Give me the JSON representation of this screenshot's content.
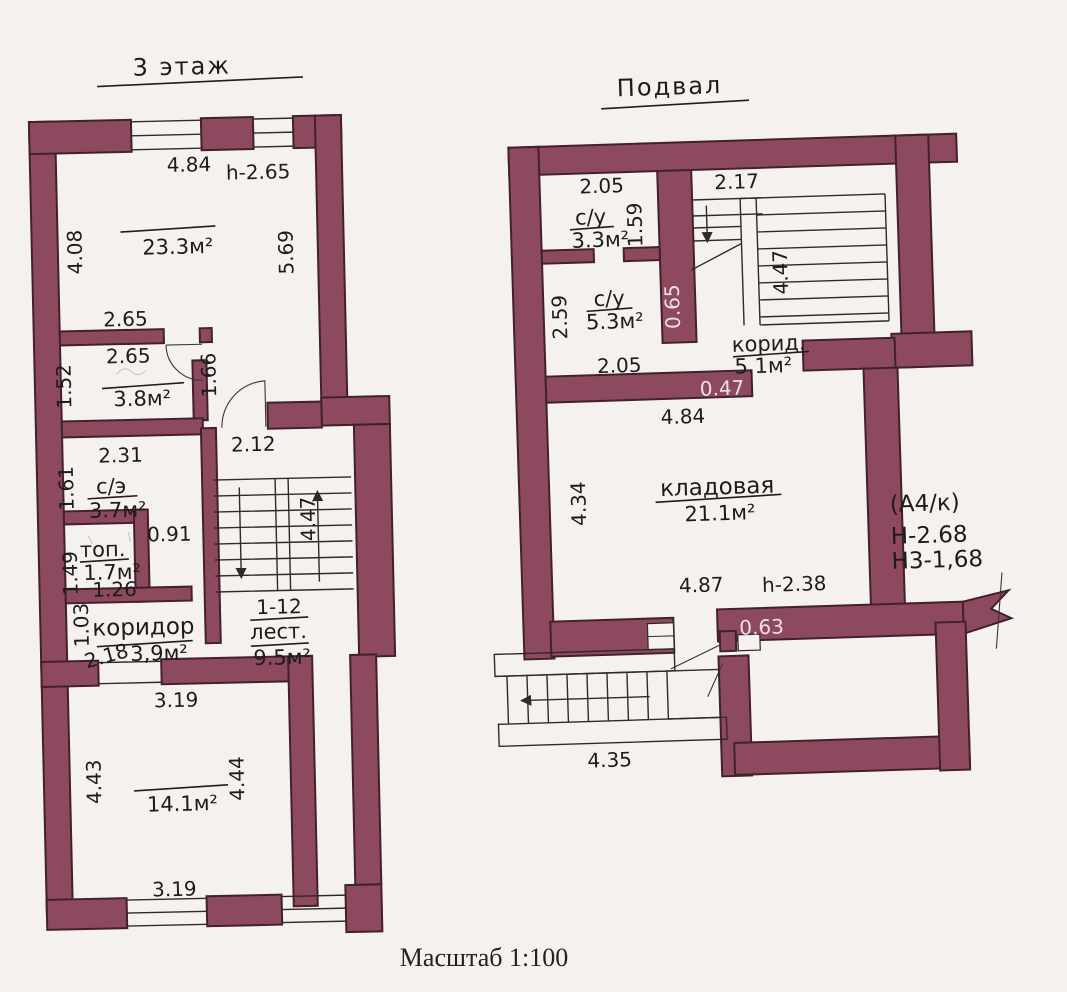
{
  "document": {
    "scale_label": "Масштаб 1:100"
  },
  "colors": {
    "wall_fill": "#8d4a5f",
    "wall_outline": "#42202d",
    "paper": "#f5f2ee",
    "ink": "#1d1b1b",
    "wall_label": "#eedfe4"
  },
  "floor3": {
    "title": "3 этаж",
    "room_233": {
      "area": "23.3м²",
      "dim_top": "4.84",
      "ceiling_height": "h-2.65",
      "dim_left": "4.08",
      "dim_right": "5.69"
    },
    "wall_dim": "2.65",
    "room_38": {
      "area": "3.8м²",
      "dim_top": "2.65",
      "dim_left": "1.52",
      "door_dim": "1.66"
    },
    "room_37": {
      "label": "с/э",
      "area": "3.7м²",
      "dim_top": "2.31",
      "dim_left": "1.61"
    },
    "room_17": {
      "label": "топ.",
      "area": "1.7м²",
      "dim_left": "1.49",
      "dim_right": "0.91",
      "dim_bottom": "1.26"
    },
    "corridor": {
      "label": "коридор",
      "area": "3,9м²",
      "dim_left": "1.03",
      "dim_width": "2.18"
    },
    "stairs": {
      "steps": "1-12",
      "label": "лест.",
      "area": "9.5м²",
      "dim_top": "2.12",
      "dim_right": "4.47"
    },
    "room_141": {
      "area": "14.1м²",
      "dim_top": "3.19",
      "dim_left": "4.43",
      "dim_right": "4.44",
      "dim_bottom": "3.19"
    }
  },
  "basement": {
    "title": "Подвал",
    "room_33": {
      "label": "с/у",
      "area": "3.3м²",
      "dim_top": "2.05",
      "dim_right": "1.59"
    },
    "room_53": {
      "label": "с/у",
      "area": "5.3м²",
      "dim_left": "2.59",
      "dim_bottom": "2.05"
    },
    "wall_065": "0.65",
    "stairs": {
      "dim_top": "2.17",
      "dim_right": "4.47"
    },
    "corridor": {
      "label": "корид.",
      "area": "5.1м²"
    },
    "wall_047": "0.47",
    "storage": {
      "label": "кладовая",
      "area": "21.1м²",
      "dim_top": "4.84",
      "dim_left": "4.34",
      "dim_bottom": "4.87",
      "ceiling_height": "h-2.38"
    },
    "annotation": {
      "line1": "(А4/к)",
      "line2": "Н-2.68",
      "line3": "Н3-1,68"
    },
    "wall_063": "0.63",
    "ext_stairs": {
      "dim": "4.35"
    }
  }
}
